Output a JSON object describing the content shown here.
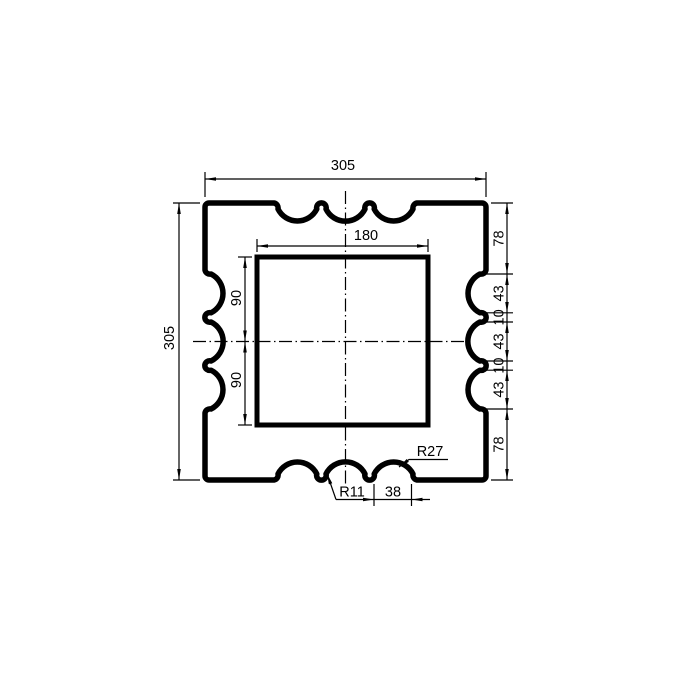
{
  "drawing": {
    "kind": "technical-dimension-drawing",
    "part": "square scalloped cap with square opening",
    "dimensions": {
      "outer_width": "305",
      "outer_height": "305",
      "inner_width": "180",
      "inner_upper_half": "90",
      "inner_lower_half": "90",
      "right_side_chain": [
        "78",
        "43",
        "10",
        "43",
        "10",
        "43",
        "78"
      ],
      "large_scallop_radius": "R27",
      "small_fillet_radius": "R11",
      "scallop_chord": "38"
    },
    "style": {
      "line_color": "#000000",
      "background_color": "#ffffff"
    }
  }
}
